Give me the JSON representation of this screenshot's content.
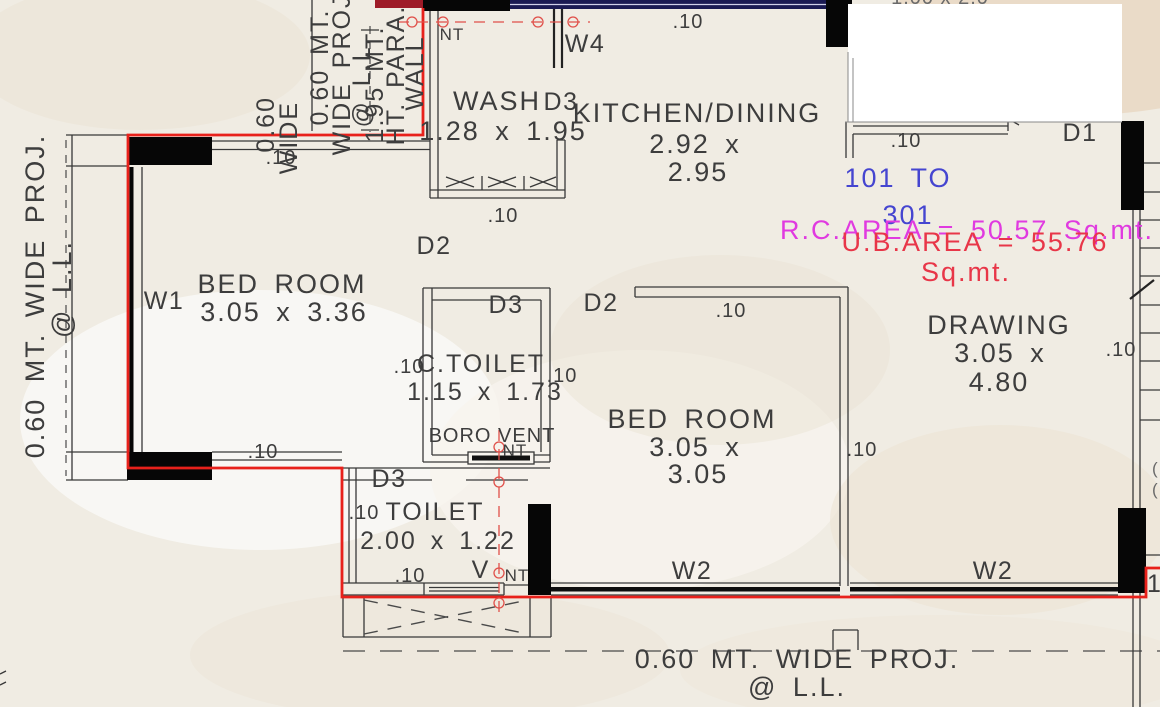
{
  "drawing_type": "architectural floor plan",
  "colors": {
    "boundary_red": "#e8211b",
    "flat_range_blue": "#4545d0",
    "rc_area_magenta": "#e03ae0",
    "ub_area_red": "#e83648",
    "cad_line": "#383838",
    "column_black": "#060606",
    "top_beam_navy": "#1a1a52",
    "paper_beige": "#f0ece3"
  },
  "rooms": [
    {
      "id": "wash",
      "name": "WASH",
      "dims": "1.28 x 1.95"
    },
    {
      "id": "kitchen_dining",
      "name": "KITCHEN/DINING",
      "dims_line1": "2.92 x",
      "dims_line2": "2.95"
    },
    {
      "id": "bed_room_1",
      "name": "BED ROOM",
      "dims": "3.05 x 3.36"
    },
    {
      "id": "c_toilet",
      "name": "C.TOILET",
      "dims": "1.15 x 1.73"
    },
    {
      "id": "bed_room_2",
      "name": "BED ROOM",
      "dims_line1": "3.05 x",
      "dims_line2": "3.05"
    },
    {
      "id": "toilet",
      "name": "TOILET",
      "dims": "2.00 x 1.22"
    },
    {
      "id": "drawing_room",
      "name": "DRAWING",
      "dims_line1": "3.05 x",
      "dims_line2": "4.80"
    }
  ],
  "openings": {
    "w1": "W1",
    "w2_bed": "W2",
    "w2_drawing": "W2",
    "w4": "W4",
    "d1": "D1",
    "d2_passage": "D2",
    "d2_kitchen": "D2",
    "d3_wash": "D3",
    "d3_ctoilet": "D3",
    "d3_toilet": "D3"
  },
  "annotations": {
    "flat_range_line1": "101 TO",
    "flat_range_line2": "301",
    "rc_area": "R.C.AREA = 50.57 Sq.mt.",
    "ub_area_line1": "U.B.AREA = 55.76",
    "ub_area_line2": "Sq.mt.",
    "boro_vent": "BORO VENT",
    "nt_top": "NT",
    "nt_boro": "NT",
    "vent_v": "V",
    "vent_nt": "NT",
    "clipped_top": "1.00 x 2.0",
    "clipped_right": "15",
    "clipped_paren": "("
  },
  "dim": {
    "ten": ".10"
  },
  "projection_notes": {
    "left_line1": "0.60 MT. WIDE PROJ.",
    "left_line2": "@ L.L.",
    "bottom_line1": "0.60 MT. WIDE PROJ.",
    "bottom_line2": "@ L.L.",
    "top_left_line1": "0.60 MT.",
    "top_left_line2": "WIDE PROJ.",
    "top_left_line3": "@ L.L.",
    "top_left_clipped1": "0.60",
    "top_left_clipped2": "WIDE",
    "para_wall_line1": "1.95 MT.",
    "para_wall_line2": "HT. PARA.",
    "para_wall_line3": "WALL"
  }
}
